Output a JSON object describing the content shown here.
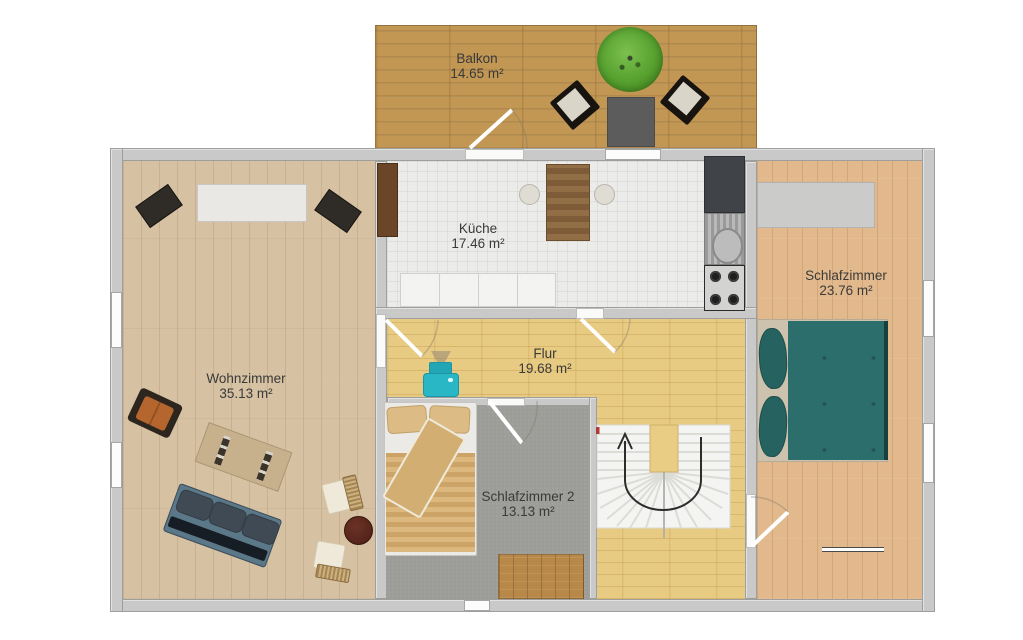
{
  "rooms": {
    "balkon": {
      "name": "Balkon",
      "area": "14.65 m²"
    },
    "kueche": {
      "name": "Küche",
      "area": "17.46 m²"
    },
    "wohnzimmer": {
      "name": "Wohnzimmer",
      "area": "35.13 m²"
    },
    "schlafzimmer": {
      "name": "Schlafzimmer",
      "area": "23.76 m²"
    },
    "flur": {
      "name": "Flur",
      "area": "19.68 m²"
    },
    "schlafzimmer2": {
      "name": "Schlafzimmer 2",
      "area": "13.13 m²"
    }
  },
  "stairs": {
    "direction": "up",
    "arrow": "u-turn-counterclockwise"
  },
  "icons": {
    "furniture": [
      "balcony-tree",
      "balcony-chair",
      "balcony-table",
      "door-swing",
      "dining-table",
      "dining-chair",
      "kitchen-counter",
      "fridge",
      "sink",
      "stove",
      "speaker",
      "sideboard",
      "armchair",
      "rug",
      "sofa",
      "wicker-chair",
      "round-side-table",
      "wardrobe",
      "double-bed",
      "wall-shelf",
      "printer",
      "single-bed",
      "wood-rug",
      "staircase"
    ]
  },
  "colors": {
    "wall": "#c9c9c9",
    "balcony_deck": "#c29753",
    "kitchen_floor": "#ebebe9",
    "living_room_floor": "#d6c1a2",
    "bedroom_floor": "#e2b98c",
    "hall_floor": "#e8cb82",
    "bedroom2_carpet": "#9c9c99",
    "bed_teal": "#2c6e6b",
    "sofa_blue": "#5b7888",
    "armchair_orange": "#b5662e",
    "tree_green": "#55a02e",
    "printer_teal": "#29b6c5",
    "stairs": "#f4f4f2"
  }
}
